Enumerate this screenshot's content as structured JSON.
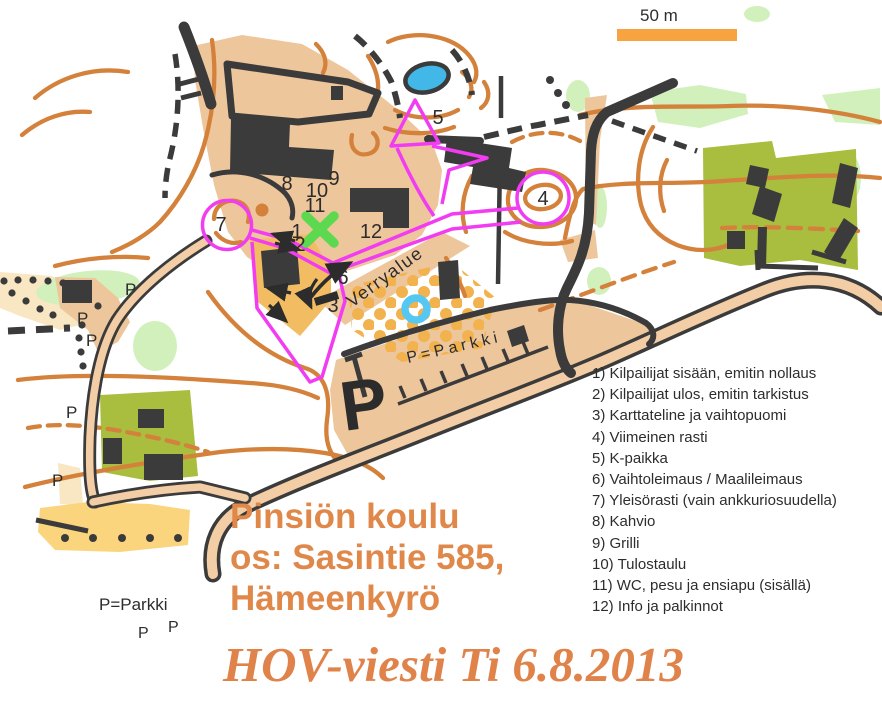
{
  "scale_bar": {
    "label": "50 m"
  },
  "legend": {
    "items": [
      "1) Kilpailijat sisään, emitin nollaus",
      "2) Kilpailijat ulos, emitin tarkistus",
      "3) Karttateline ja vaihtopuomi",
      "4) Viimeinen rasti",
      "5) K-paikka",
      "6) Vaihtoleimaus / Maalileimaus",
      "7) Yleisörasti (vain ankkuriosuudella)",
      "8) Kahvio",
      "9) Grilli",
      "10) Tulostaulu",
      "11) WC, pesu ja ensiapu (sisällä)",
      "12) Info ja palkinnot"
    ]
  },
  "venue": {
    "line1": "Pinsiön koulu",
    "line2": "os: Sasintie 585,",
    "line3": "Hämeenkyrö"
  },
  "event_title": "HOV-viesti Ti 6.8.2013",
  "parking_note": {
    "label": "P=Parkki",
    "p_left": "P",
    "p_right": "P"
  },
  "map": {
    "warmup_area_label": "Verryalue",
    "parking_area_label": "P=Parkki",
    "parking_big_p": "P",
    "p_markers": [
      "P",
      "P",
      "P",
      "P",
      "P"
    ],
    "controls": {
      "c1": "1",
      "c2": "2",
      "c3": "3",
      "c4": "4",
      "c5": "5",
      "c6": "6",
      "c7": "7",
      "c8": "8",
      "c9": "9",
      "c10": "10",
      "c11": "11",
      "c12": "12"
    }
  },
  "colors": {
    "course_magenta": "#f23cf2",
    "contour_orange": "#d4813b",
    "title_orange": "#e0884a",
    "scale_bar_orange": "#f7a440",
    "open_land_tan": "#eec69b",
    "paved_sand": "#f2bd62",
    "rough_open_yellow": "#fbd47e",
    "cultivated_olive": "#a9bd3e",
    "vegetation_green": "#d2f0bc",
    "water_blue": "#42b8e9",
    "dark": "#3b3b3b",
    "crossing_green": "#5cd94e"
  }
}
